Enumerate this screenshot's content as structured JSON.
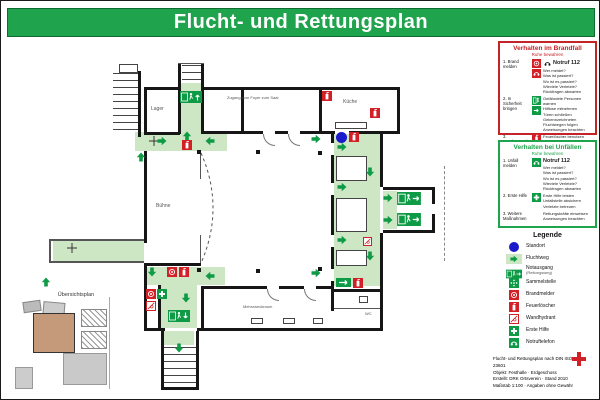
{
  "title": "Flucht- und Rettungsplan",
  "panels": {
    "fire": {
      "title": "Verhalten im Brandfall",
      "subtitle": "Ruhe bewahren",
      "steps": [
        {
          "label": "1. Brand melden",
          "emergency": "Notruf 112",
          "lines": [
            "Wer meldet?",
            "Was ist passiert?",
            "Wo ist es passiert?",
            "Wieviele Verletzte?",
            "Rückfragen abwarten"
          ]
        },
        {
          "label": "2. In Sicherheit bringen",
          "lines": [
            "Gefährdete Personen warnen",
            "Hilflose mitnehmen",
            "Türen schließen",
            "Gekennzeichneten Fluchtwegen folgen",
            "Anweisungen beachten"
          ]
        },
        {
          "label": "3. Löschversuch unternehmen",
          "lines": [
            "Feuerlöscher benutzen"
          ]
        }
      ]
    },
    "accident": {
      "title": "Verhalten bei Unfällen",
      "subtitle": "Ruhe bewahren",
      "steps": [
        {
          "label": "1. Unfall melden",
          "emergency": "Notruf 112",
          "lines": [
            "Wer meldet?",
            "Was ist passiert?",
            "Wo ist es passiert?",
            "Wieviele Verletzte?",
            "Rückfragen abwarten"
          ]
        },
        {
          "label": "2. Erste Hilfe",
          "lines": [
            "Erste Hilfe leisten",
            "Unfallstelle absichern",
            "Verletzte betreuen"
          ]
        },
        {
          "label": "3. Weitere Maßnahmen",
          "lines": [
            "Rettungskräfte einweisen",
            "Anweisungen beachten"
          ]
        }
      ]
    }
  },
  "legend": {
    "title": "Legende",
    "items": [
      {
        "icon": "location-icon",
        "label": "Standort"
      },
      {
        "icon": "escape-route-icon",
        "label": "Fluchtweg"
      },
      {
        "icon": "emergency-exit-icon",
        "label": "Notausgang",
        "sub": "(Rettungsweg)"
      },
      {
        "icon": "assembly-point-icon",
        "label": "Sammelstelle"
      },
      {
        "icon": "fire-alarm-icon",
        "label": "Brandmelder"
      },
      {
        "icon": "fire-extinguisher-icon",
        "label": "Feuerlöscher"
      },
      {
        "icon": "wall-hydrant-icon",
        "label": "Wandhydrant"
      },
      {
        "icon": "first-aid-icon",
        "label": "Erste Hilfe"
      },
      {
        "icon": "emergency-phone-icon",
        "label": "Notruftelefon"
      }
    ]
  },
  "plan": {
    "rooms": {
      "storage": "Lager",
      "kitchen": "Küche",
      "stage": "Bühne",
      "foyer_note": "Zugang vom Foyer zum Saal",
      "club_room": "Mehrzweckraum",
      "wc": "WC"
    },
    "overview_title": "Übersichtsplan"
  },
  "footer": {
    "lines": [
      "Flucht- und Rettungsplan nach DIN ISO 23601",
      "Objekt: Festhalle · Erdgeschoss",
      "Erstellt: DRK Ortsverein · Stand 2010",
      "Maßstab 1:100 · Angaben ohne Gewähr"
    ]
  },
  "colors": {
    "banner_green": "#1fa34c",
    "route_green": "#cde7c4",
    "safety_green": "#0f9b46",
    "alarm_red": "#d31f26",
    "location_blue": "#1a1acc",
    "fire_panel_border": "#c42428"
  }
}
